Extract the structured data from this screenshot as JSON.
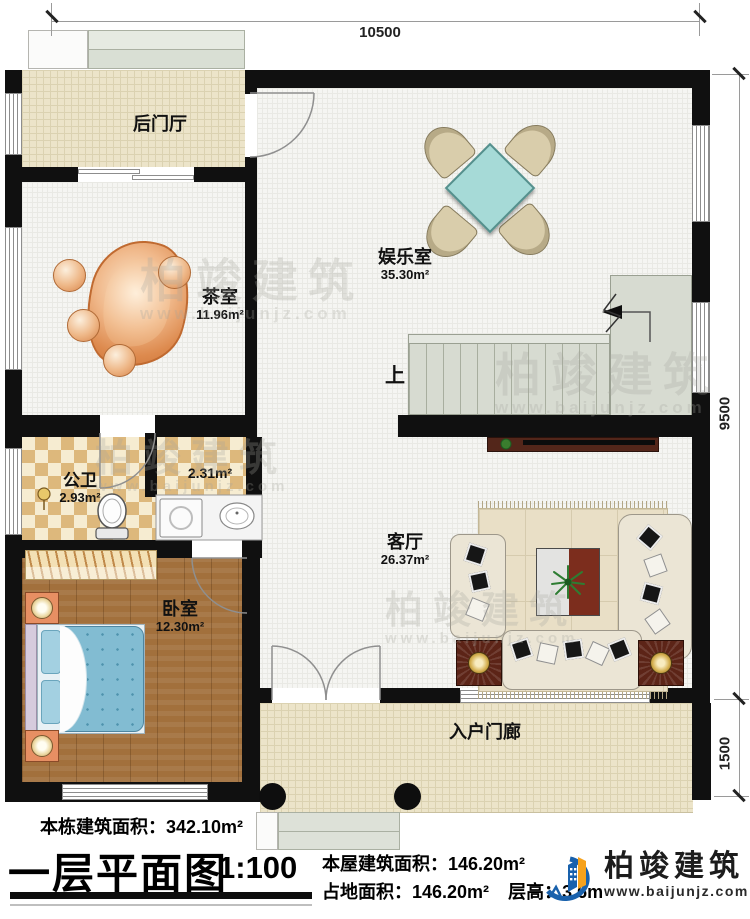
{
  "dimensions": {
    "top_width": "10500",
    "right_height": "9500",
    "porch_height": "1500"
  },
  "rooms": {
    "back_hall": {
      "name": "后门厅"
    },
    "tea": {
      "name": "茶室",
      "area": "11.96m²"
    },
    "entertainment": {
      "name": "娱乐室",
      "area": "35.30m²"
    },
    "bath": {
      "name": "公卫",
      "area": "2.93m²"
    },
    "laundry": {
      "area": "2.31m²"
    },
    "bedroom": {
      "name": "卧室",
      "area": "12.30m²"
    },
    "living": {
      "name": "客厅",
      "area": "26.37m²"
    },
    "porch": {
      "name": "入户门廊"
    },
    "stairs": {
      "up_label": "上"
    }
  },
  "footer": {
    "total_area_label": "本栋建筑面积：",
    "total_area_value": "342.10m²",
    "title": "一层平面图",
    "scale": "1:100",
    "floor_area_label": "本屋建筑面积：",
    "floor_area_value": "146.20m²",
    "footprint_label": "占地面积：",
    "footprint_value": "146.20m²",
    "height_label": "层高：",
    "height_value": "3.6m"
  },
  "brand": {
    "name": "柏竣建筑",
    "website": "www.baijunjz.com"
  },
  "watermark": {
    "text": "柏竣建筑",
    "subtext": "www.baijunjz.com"
  },
  "colors": {
    "wall": "#101010",
    "floor_wood": "#a2703c",
    "floor_tile": "#ece4c9",
    "checker": "#ddb87c",
    "bed_blue": "#82bcd2",
    "table_cyan": "#a6dad7",
    "tea_table_orange": "#dd8a4e",
    "stair_green": "#d7dbd1",
    "dark_wood": "#5c2417",
    "brand_blue": "#1961ac",
    "brand_orange": "#f6a21d"
  }
}
